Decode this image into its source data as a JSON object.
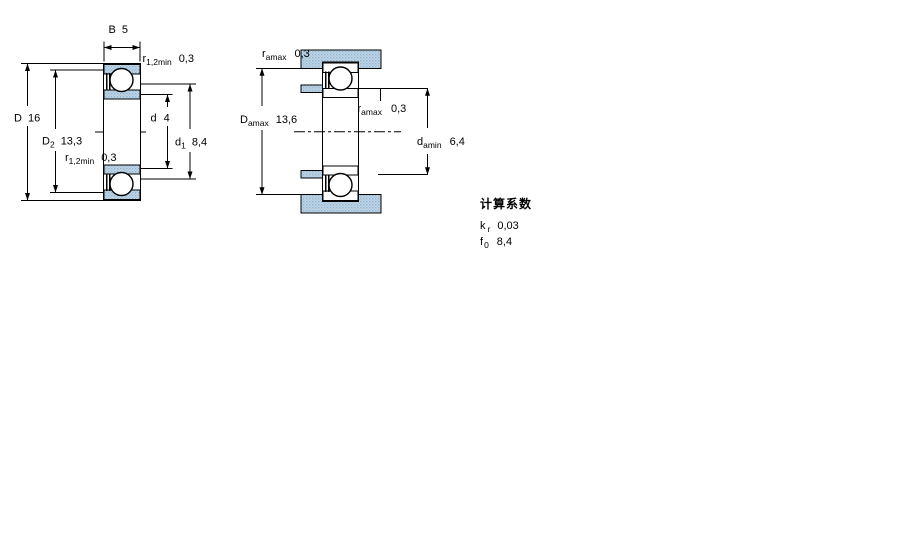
{
  "drawing_title": "bearing-dimension-drawing",
  "colors": {
    "fill_light": "#c2d7e8",
    "fill_dot": "#8fb2cd",
    "line": "#000000"
  },
  "left_diagram": {
    "width_b": {
      "base": "B",
      "value": "5"
    },
    "outer_diameter": {
      "base": "D",
      "value": "16"
    },
    "d2": {
      "base": "D",
      "sub": "2",
      "value": "13,3"
    },
    "r_top": {
      "base": "r",
      "sub": "1,2min",
      "value": "0,3"
    },
    "r_bottom": {
      "base": "r",
      "sub": "1,2min",
      "value": "0,3"
    },
    "bore_diameter": {
      "base": "d",
      "value": "4"
    },
    "d1": {
      "base": "d",
      "sub": "1",
      "value": "8,4"
    }
  },
  "right_diagram": {
    "r_a_top": {
      "base": "r",
      "sub": "amax",
      "value": "0,3"
    },
    "da_max": {
      "base": "D",
      "sub": "amax",
      "value": "13,6"
    },
    "r_a_mid": {
      "base": "r",
      "sub": "amax",
      "value": "0,3"
    },
    "da_min": {
      "base": "d",
      "sub": "amin",
      "value": "6,4"
    }
  },
  "calculation_factors": {
    "heading": "计算系数",
    "kr": {
      "base": "k",
      "sub": "r",
      "value": "0,03"
    },
    "f0": {
      "base": "f",
      "sub": "0",
      "value": "8,4"
    }
  }
}
